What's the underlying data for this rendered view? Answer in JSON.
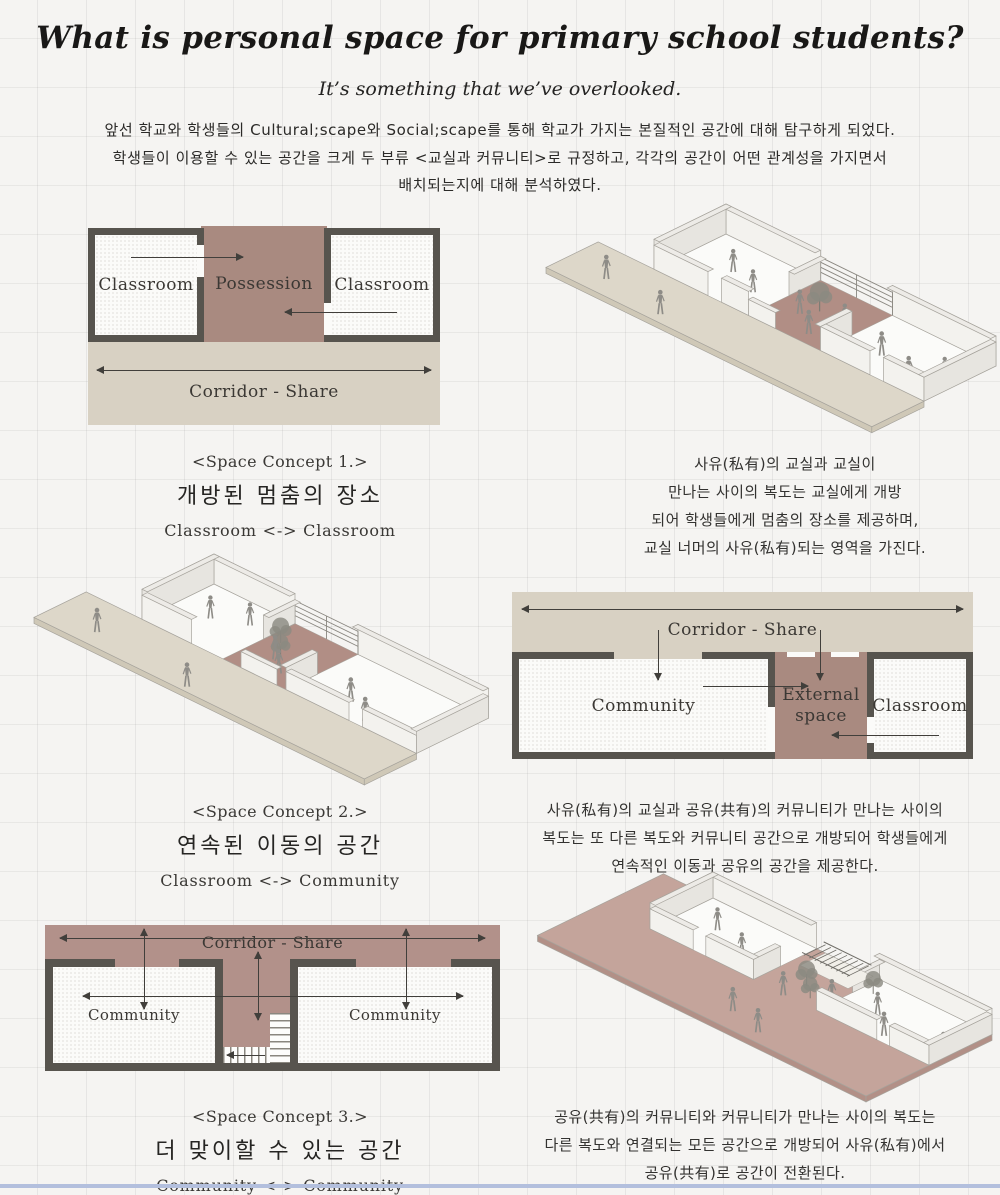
{
  "header": {
    "title": "What is personal space for primary school students?",
    "subtitle": "It’s something that we’ve overlooked.",
    "paragraph_lines": [
      "앞선 학교와 학생들의 Cultural;scape와 Social;scape를 통해 학교가 가지는 본질적인 공간에 대해 탐구하게 되었다.",
      "학생들이 이용할 수 있는 공간을 크게 두 부류 <교실과 커뮤니티>로 규정하고, 각각의 공간이 어떤 관계성을 가지면서",
      "배치되는지에 대해 분석하였다."
    ]
  },
  "concept1": {
    "plan": {
      "left_room": "Classroom",
      "center_area": "Possession",
      "right_room": "Classroom",
      "corridor": "Corridor - Share"
    },
    "caption_tag": "<Space Concept 1.>",
    "caption_title": "개방된 멈춤의 장소",
    "caption_sub": "Classroom <-> Classroom",
    "description_lines": [
      "사유(私有)의 교실과 교실이",
      "만나는 사이의 복도는 교실에게 개방",
      "되어 학생들에게 멈춤의 장소를 제공하며,",
      "교실 너머의 사유(私有)되는 영역을 가진다."
    ]
  },
  "concept2": {
    "plan": {
      "corridor": "Corridor - Share",
      "left_room": "Community",
      "center_line1": "External",
      "center_line2": "space",
      "right_room": "Classroom"
    },
    "caption_tag": "<Space Concept 2.>",
    "caption_title": "연속된 이동의 공간",
    "caption_sub": "Classroom <-> Community",
    "description_lines": [
      "사유(私有)의 교실과 공유(共有)의 커뮤니티가 만나는 사이의",
      "복도는 또 다른 복도와 커뮤니티 공간으로 개방되어 학생들에게",
      "연속적인 이동과 공유의 공간을 제공한다."
    ]
  },
  "concept3": {
    "plan": {
      "corridor": "Corridor - Share",
      "left_room": "Community",
      "right_room": "Community"
    },
    "caption_tag": "<Space Concept 3.>",
    "caption_title": "더 맞이할 수 있는 공간",
    "caption_sub": "Community <-> Community",
    "description_lines": [
      "공유(共有)의 커뮤니티와 커뮤니티가 만나는 사이의 복도는",
      "다른 복도와 연결되는 모든 공간으로 개방되어 사유(私有)에서",
      "공유(共有)로 공간이 전환된다."
    ]
  },
  "colors": {
    "mauve": "#a98a80",
    "corridor_beige": "#d8d1c3",
    "wall_dark": "#57544e",
    "bottom_bar": "#b3bfdd"
  }
}
